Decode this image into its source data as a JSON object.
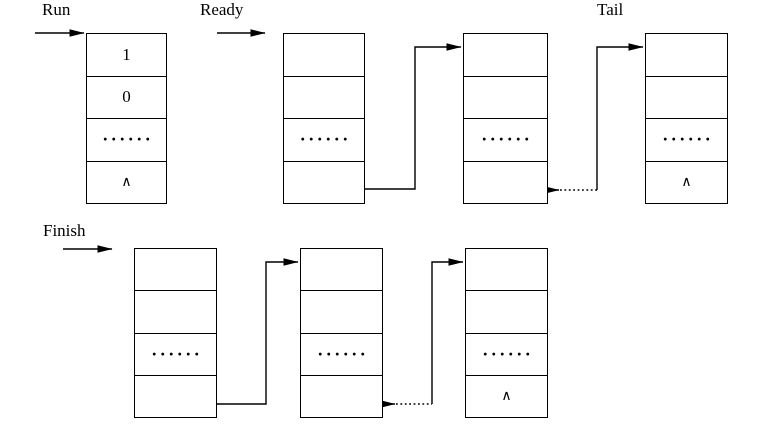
{
  "diagram": {
    "labels": {
      "run": "Run",
      "ready": "Ready",
      "tail": "Tail",
      "finish": "Finish"
    },
    "boxes": [
      {
        "id": "run-pcb",
        "cells": [
          "1",
          "0",
          "······",
          "∧"
        ]
      },
      {
        "id": "ready-pcb-1",
        "cells": [
          "",
          "",
          "······",
          ""
        ]
      },
      {
        "id": "ready-pcb-2",
        "cells": [
          "",
          "",
          "······",
          ""
        ]
      },
      {
        "id": "ready-pcb-tail",
        "cells": [
          "",
          "",
          "······",
          "∧"
        ]
      },
      {
        "id": "finish-pcb-1",
        "cells": [
          "",
          "",
          "······",
          ""
        ]
      },
      {
        "id": "finish-pcb-2",
        "cells": [
          "",
          "",
          "······",
          ""
        ]
      },
      {
        "id": "finish-pcb-last",
        "cells": [
          "",
          "",
          "······",
          "∧"
        ]
      }
    ],
    "links": [
      {
        "from": "run-pointer",
        "to": "run-pcb",
        "style": "solid"
      },
      {
        "from": "ready-pointer",
        "to": "ready-pcb-1",
        "style": "solid"
      },
      {
        "from": "ready-pcb-1-link",
        "to": "ready-pcb-2",
        "style": "solid"
      },
      {
        "from": "ready-pcb-2-link",
        "to": "ready-pcb-tail",
        "style": "dotted-then-solid"
      },
      {
        "from": "tail-pointer",
        "to": "ready-pcb-tail",
        "style": "solid"
      },
      {
        "from": "finish-pointer",
        "to": "finish-pcb-1",
        "style": "solid"
      },
      {
        "from": "finish-pcb-1-link",
        "to": "finish-pcb-2",
        "style": "solid"
      },
      {
        "from": "finish-pcb-2-link",
        "to": "finish-pcb-last",
        "style": "dotted-then-solid"
      }
    ],
    "colors": {
      "background": "#ffffff",
      "line": "#000000",
      "text": "#000000"
    }
  }
}
